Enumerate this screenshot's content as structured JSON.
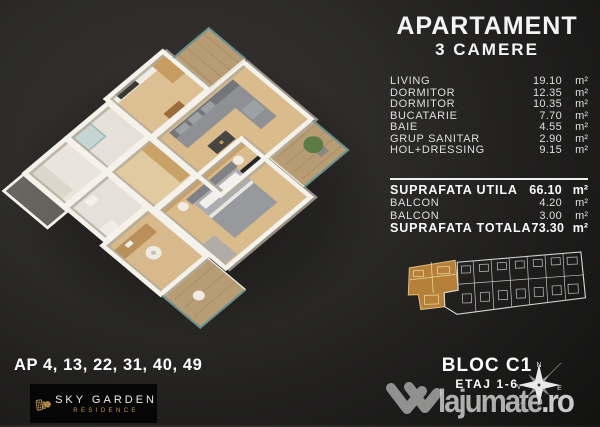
{
  "title": {
    "line1": "APARTAMENT",
    "line2": "3 CAMERE"
  },
  "room_list": {
    "rows": [
      {
        "label": "LIVING",
        "value": "19.10",
        "unit": "m²"
      },
      {
        "label": "DORMITOR",
        "value": "12.35",
        "unit": "m²"
      },
      {
        "label": "DORMITOR",
        "value": "10.35",
        "unit": "m²"
      },
      {
        "label": "BUCATARIE",
        "value": "7.70",
        "unit": "m²"
      },
      {
        "label": "BAIE",
        "value": "4.55",
        "unit": "m²"
      },
      {
        "label": "GRUP SANITAR",
        "value": "2.90",
        "unit": "m²"
      },
      {
        "label": "HOL+DRESSING",
        "value": "9.15",
        "unit": "m²"
      }
    ]
  },
  "totals": {
    "rows": [
      {
        "label": "SUPRAFATA UTILA",
        "value": "66.10",
        "unit": "m²",
        "emphasis": true
      },
      {
        "label": "BALCON",
        "value": "4.20",
        "unit": "m²",
        "emphasis": false
      },
      {
        "label": "BALCON",
        "value": "3.00",
        "unit": "m²",
        "emphasis": false
      },
      {
        "label": "SUPRAFATA TOTALA",
        "value": "73.30",
        "unit": "m²",
        "emphasis": true
      }
    ]
  },
  "footer_left": {
    "apartments": "AP 4, 13, 22, 31, 40, 49"
  },
  "brand": {
    "name": "SKY GARDEN",
    "subtitle": "RESIDENCE"
  },
  "building": {
    "block": "BLOC C1",
    "floors": "ETAJ 1-6"
  },
  "compass": {
    "north": "N",
    "south": "S",
    "east": "E",
    "west": "V"
  },
  "watermark": {
    "name": "lajumate",
    "tld": ".ro"
  },
  "icons": {
    "compass": "compass-rose-icon",
    "brand": "sky-garden-buildings-icon",
    "watermark": "lajumate-w-icon"
  },
  "colors": {
    "highlight_gold": "#b5803a",
    "logo_gold": "#c79b4e",
    "panel_text": "#dfdfdf",
    "background_dark": "#131312"
  }
}
